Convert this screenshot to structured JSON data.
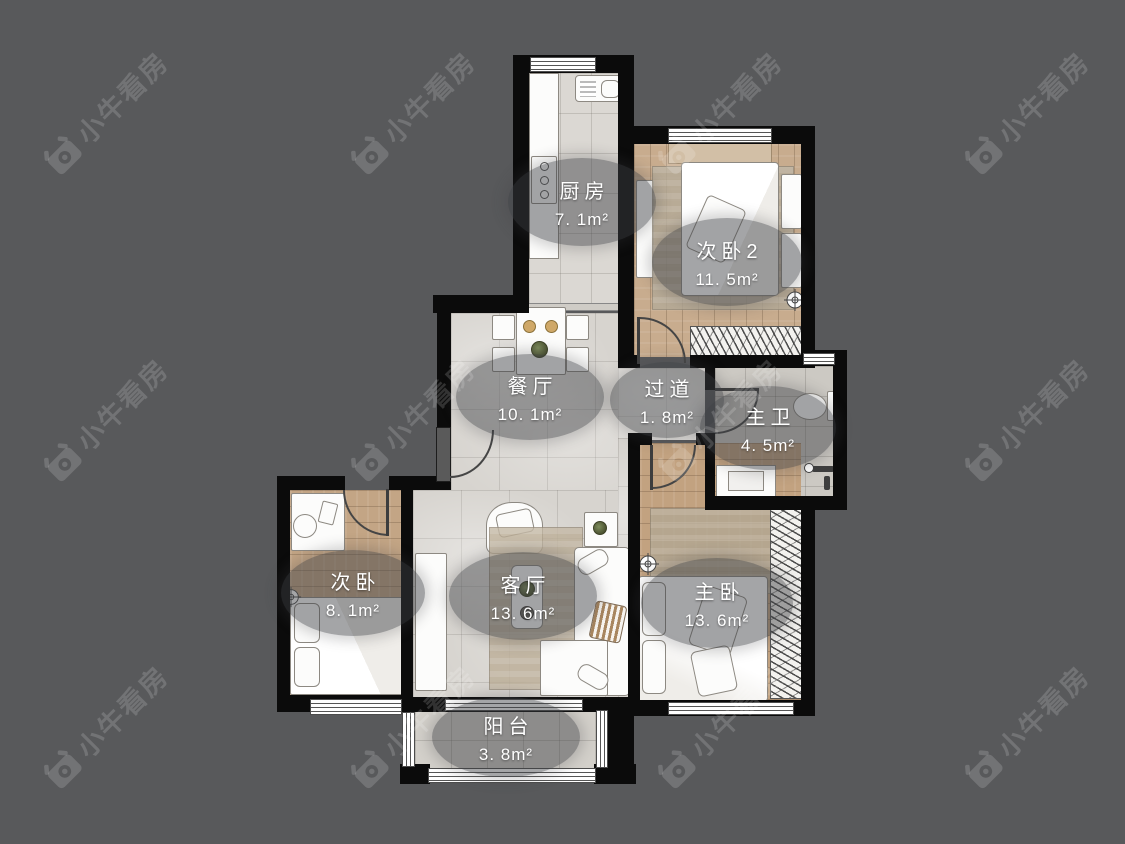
{
  "page": {
    "background_color": "#58595b"
  },
  "watermark": {
    "text": "小牛看房",
    "color": "#6e6f71",
    "logo": "niu-bull-logo-icon"
  },
  "floorplan": {
    "wall_color": "#0b0b0b",
    "label_background": "rgba(62,64,68,0.47)",
    "rooms": [
      {
        "id": "kitchen",
        "name": "厨房",
        "area": "7. 1m²"
      },
      {
        "id": "bedroom2",
        "name": "次卧2",
        "area": "11. 5m²"
      },
      {
        "id": "dining",
        "name": "餐厅",
        "area": "10. 1m²"
      },
      {
        "id": "hallway",
        "name": "过道",
        "area": "1. 8m²"
      },
      {
        "id": "master-bath",
        "name": "主卫",
        "area": "4. 5m²"
      },
      {
        "id": "bedroom",
        "name": "次卧",
        "area": "8. 1m²"
      },
      {
        "id": "living",
        "name": "客厅",
        "area": "13. 6m²"
      },
      {
        "id": "master-bedroom",
        "name": "主卧",
        "area": "13. 6m²"
      },
      {
        "id": "balcony",
        "name": "阳台",
        "area": "3. 8m²"
      }
    ]
  }
}
